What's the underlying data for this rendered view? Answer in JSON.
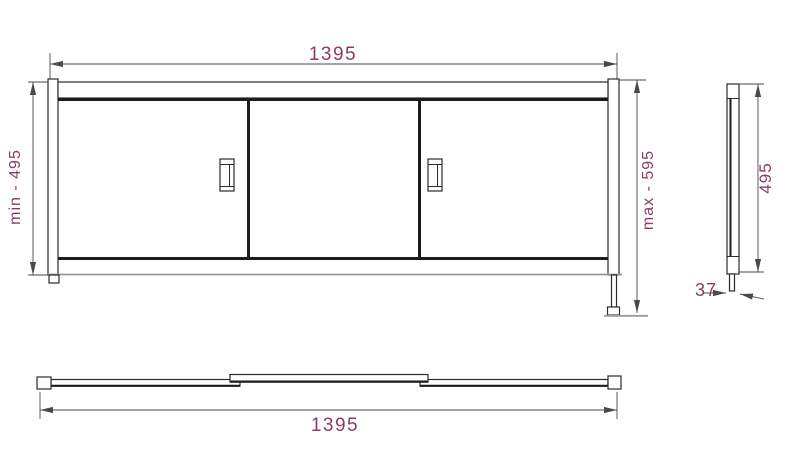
{
  "drawing": {
    "type": "technical-drawing",
    "subject": "three-panel sliding bath screen, front / side / top orthographic views"
  },
  "front_view": {
    "width_label": "1395",
    "min_height_label": "min - 495",
    "max_height_label": "max - 595"
  },
  "side_view": {
    "height_label": "495",
    "depth_label": "37"
  },
  "top_view": {
    "width_label": "1395"
  },
  "colors": {
    "background": "#ffffff",
    "outline": "#2b2b2b",
    "thick_line": "#1c1c1c",
    "gray_line": "#9a9a9a",
    "dim_line": "#4a4a4a",
    "dim_text": "#8e3b66"
  }
}
